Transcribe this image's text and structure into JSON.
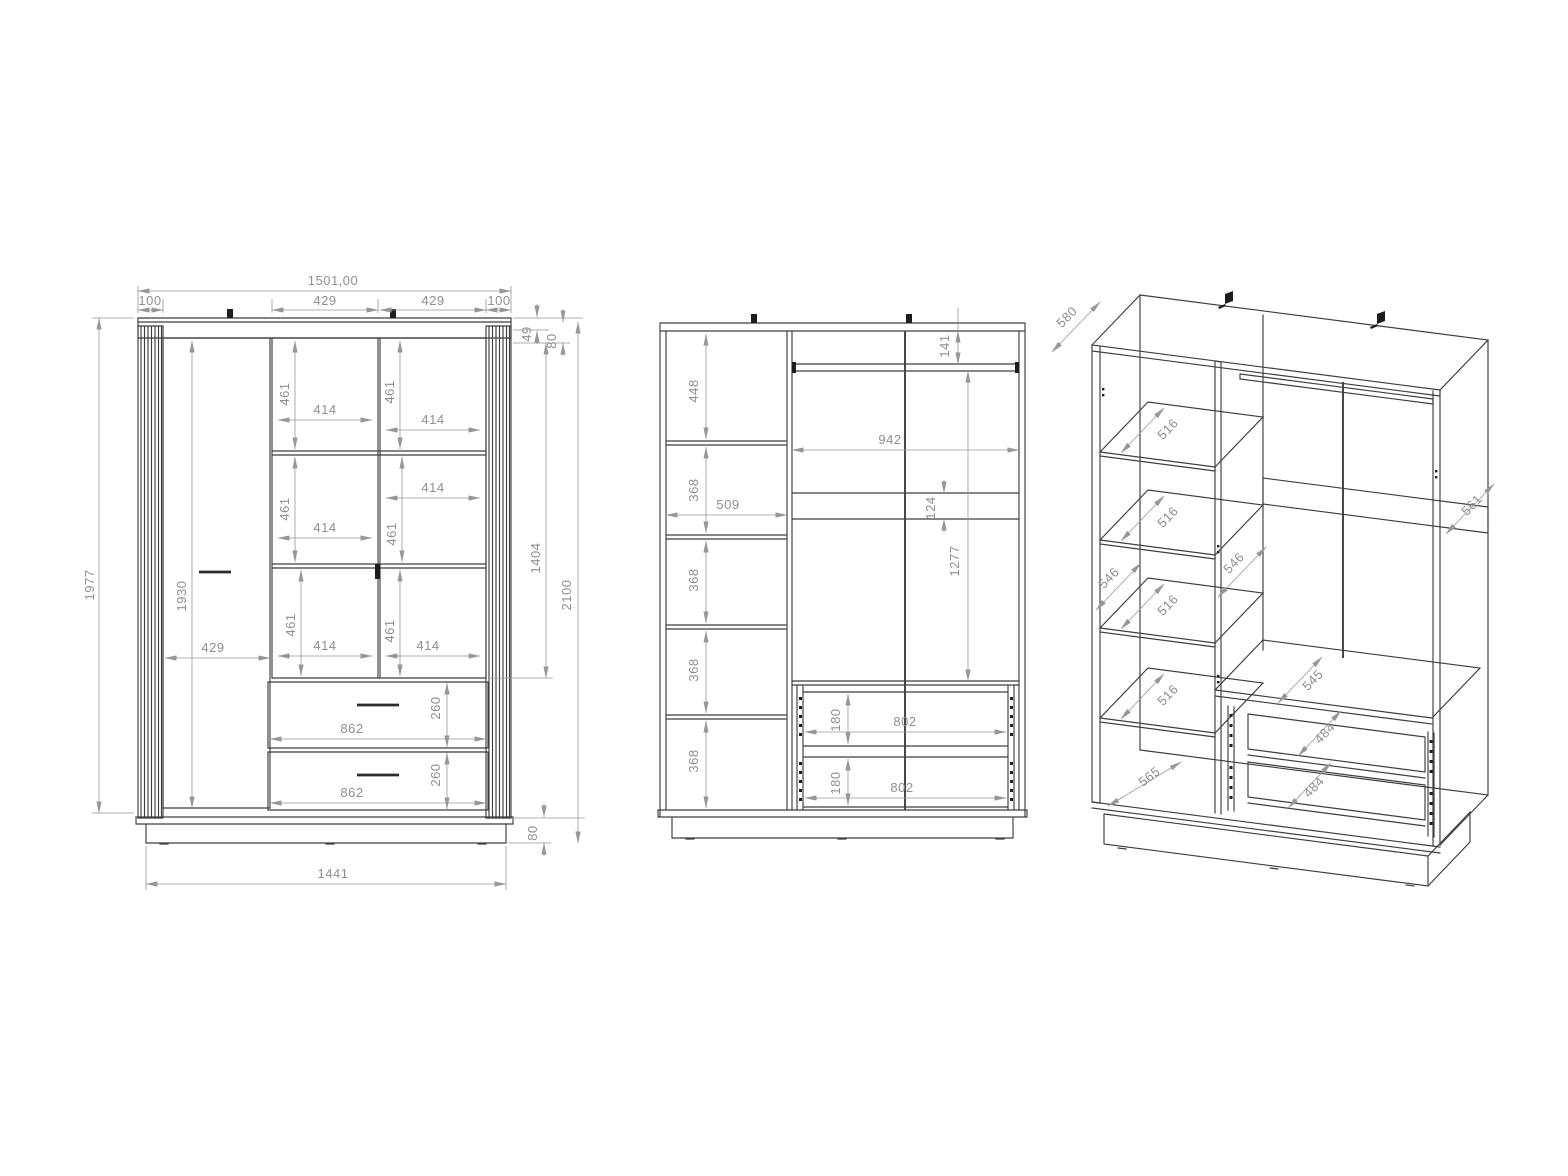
{
  "drawing": {
    "colors": {
      "object_line": "#3e3e3e",
      "dimension_line": "#979797",
      "text": "#8f8f8f",
      "background": "#ffffff"
    },
    "front": {
      "total_width": "1501,00",
      "segments": [
        "100",
        "429",
        "429",
        "100"
      ],
      "top_inset": "49",
      "top_panel": "80",
      "height_overall": "1977",
      "door_height": "1930",
      "left_door_width": "429",
      "cells": [
        {
          "h": "461",
          "w": "414"
        },
        {
          "h": "461",
          "w": "414"
        },
        {
          "h": "461",
          "w": "414"
        },
        {
          "h": "461",
          "w": "414"
        },
        {
          "h": "461",
          "w": "414"
        },
        {
          "h": "461",
          "w": "414"
        }
      ],
      "drawers": [
        {
          "w": "862",
          "h": "260"
        },
        {
          "w": "862",
          "h": "260"
        }
      ],
      "base_height": "80",
      "base_width": "1441",
      "door_section_height": "1404",
      "height_total": "2100"
    },
    "internal": {
      "compartments": [
        "448",
        "368",
        "368",
        "368",
        "368"
      ],
      "column_width": "509",
      "rod_offset": "141",
      "interior_width": "942",
      "rail_height": "124",
      "rod_to_drawer": "1277",
      "drawers": [
        {
          "h": "180",
          "w": "802"
        },
        {
          "h": "180",
          "w": "802"
        }
      ]
    },
    "iso": {
      "top_depth": "580",
      "shelves": [
        "516",
        "516",
        "516",
        "516"
      ],
      "side_panel": "546",
      "partition": "546",
      "floor": "565",
      "drawer_shelf": "545",
      "drawers": [
        "484",
        "484"
      ],
      "right_panel": "561"
    }
  }
}
